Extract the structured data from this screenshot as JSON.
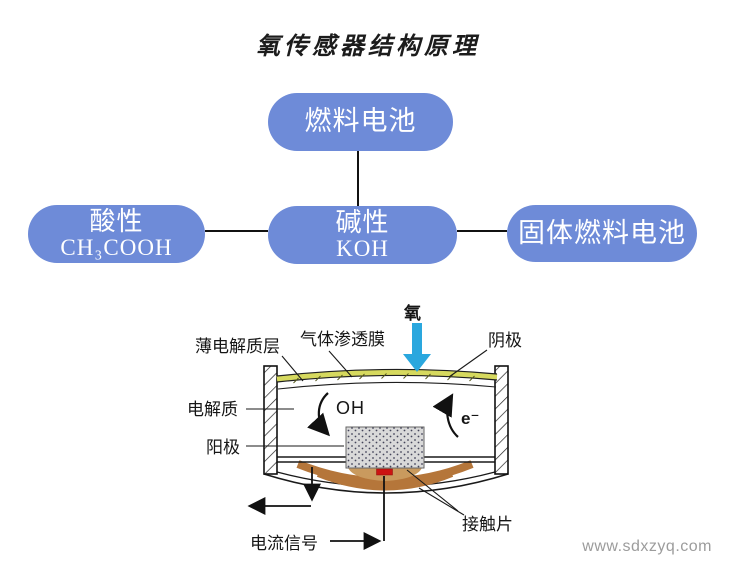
{
  "title": "氧传感器结构原理",
  "colors": {
    "box_blue": "#6e8bd8",
    "membrane_yellow": "#d6d95e",
    "copper_brown": "#b5763a",
    "contact_tan": "#c99a5e",
    "signal_red": "#cc1412",
    "oxygen_arrow_blue": "#2aa7de",
    "text_black": "#1a1a1a",
    "watermark_gray": "#9c9c9c"
  },
  "flowchart": {
    "top_box": {
      "label": "燃料电池"
    },
    "left_box": {
      "label": "酸性",
      "formula": "CH₃COOH"
    },
    "middle_box": {
      "label": "碱性",
      "formula": "KOH"
    },
    "right_box": {
      "label": "固体燃料电池"
    }
  },
  "diagram": {
    "labels": {
      "oxygen": "氧",
      "thin_electrolyte_layer": "薄电解质层",
      "gas_permeable_membrane": "气体渗透膜",
      "cathode": "阴极",
      "electrolyte": "电解质",
      "anode": "阳极",
      "hydroxide": "OH",
      "electron": "e⁻",
      "current_signal": "电流信号",
      "contact_piece": "接触片"
    }
  },
  "watermark": "www.sdxzyq.com"
}
